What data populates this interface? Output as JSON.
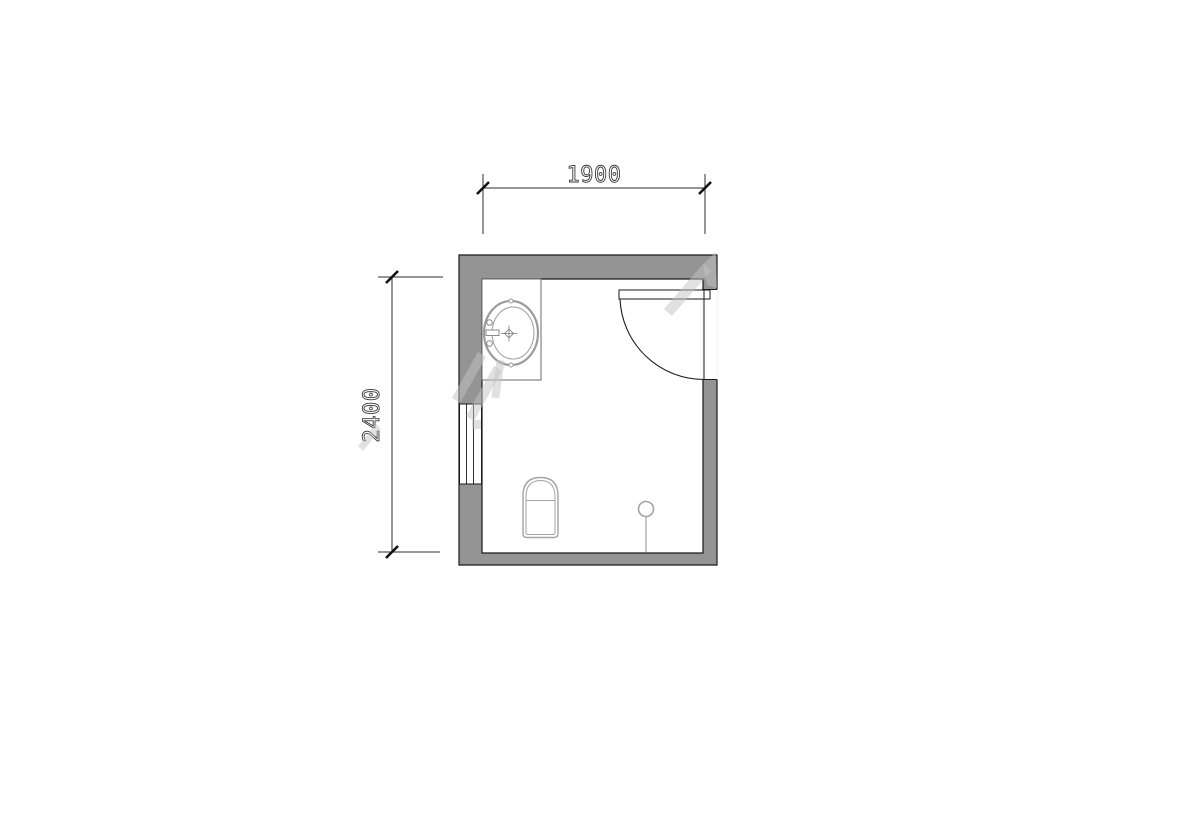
{
  "document": {
    "type": "floor-plan",
    "description": "bathroom floor plan with wash basin counter, squat toilet, floor drain, inswing door and window",
    "background": "#ffffff"
  },
  "dimensions": {
    "width_mm": "1900",
    "height_mm": "2400"
  },
  "colors": {
    "wall_fill": "#949494",
    "outline": "#1a1a1a",
    "fixture_line": "#a0a0a0",
    "counter_line": "#6b6b6b",
    "dimension_line": "#2e2e2e",
    "dimension_text": "#3a3a3a",
    "watermark": "rgba(195,195,195,0.5)"
  }
}
